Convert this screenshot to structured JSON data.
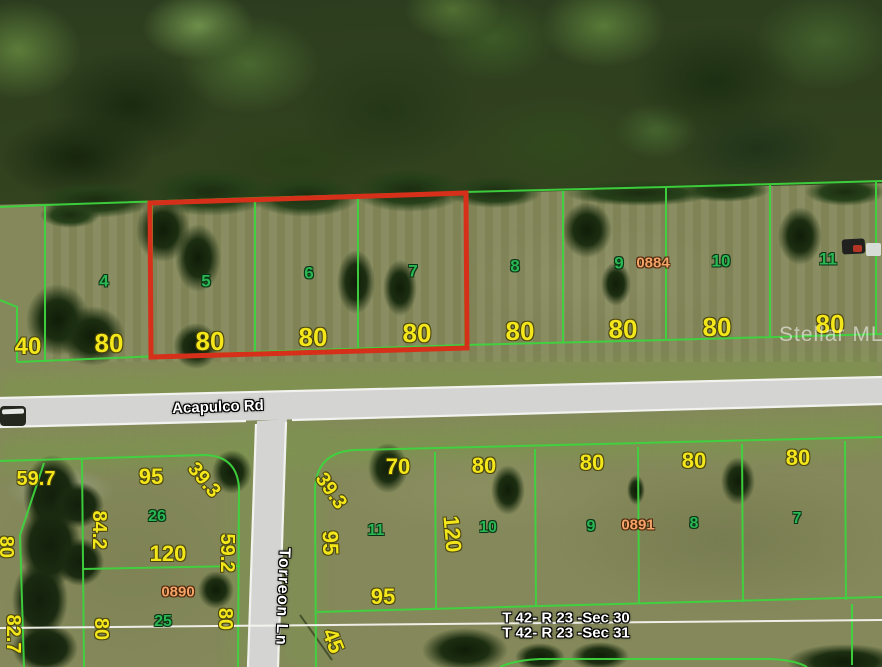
{
  "image": {
    "kind": "aerial plat map photo",
    "width": 882,
    "height": 667
  },
  "watermark": {
    "text": "Stellar MLS"
  },
  "streets": {
    "horizontal": "Acapulco Rd",
    "vertical": "Torreon Ln"
  },
  "section_lines": {
    "above": "T 42- R 23 -Sec 30",
    "below": "T 42- R 23 -Sec 31"
  },
  "highlight": {
    "outlined_lots": [
      "5",
      "6",
      "7"
    ],
    "color": "#d6301a"
  },
  "colors": {
    "plat_line_green": "#3ed43e",
    "lot_number_green": "#2bb654",
    "dimension_yellow": "#f3e71c",
    "plat_book_orange": "#f2a469",
    "highlight_red": "#d6301a",
    "road_gray": "#d4d4d2",
    "section_line_white": "#f5f5f0"
  },
  "map_labels": [
    {
      "text": "40",
      "kind": "dim",
      "x": 28,
      "y": 347,
      "s": 24
    },
    {
      "text": "80",
      "kind": "dim",
      "x": 109,
      "y": 343,
      "s": 26
    },
    {
      "text": "80",
      "kind": "dim",
      "x": 210,
      "y": 341,
      "s": 26
    },
    {
      "text": "80",
      "kind": "dim",
      "x": 313,
      "y": 337,
      "s": 26
    },
    {
      "text": "80",
      "kind": "dim",
      "x": 417,
      "y": 333,
      "s": 26
    },
    {
      "text": "80",
      "kind": "dim",
      "x": 520,
      "y": 331,
      "s": 26
    },
    {
      "text": "80",
      "kind": "dim",
      "x": 623,
      "y": 329,
      "s": 26
    },
    {
      "text": "80",
      "kind": "dim",
      "x": 717,
      "y": 327,
      "s": 26
    },
    {
      "text": "80",
      "kind": "dim",
      "x": 830,
      "y": 324,
      "s": 26
    },
    {
      "text": "4",
      "kind": "lot",
      "x": 104,
      "y": 281,
      "s": 17
    },
    {
      "text": "5",
      "kind": "lot",
      "x": 206,
      "y": 281,
      "s": 17
    },
    {
      "text": "6",
      "kind": "lot",
      "x": 309,
      "y": 273,
      "s": 17
    },
    {
      "text": "7",
      "kind": "lot",
      "x": 413,
      "y": 271,
      "s": 17
    },
    {
      "text": "8",
      "kind": "lot",
      "x": 515,
      "y": 266,
      "s": 17
    },
    {
      "text": "9",
      "kind": "lot",
      "x": 619,
      "y": 263,
      "s": 17
    },
    {
      "text": "0884",
      "kind": "plat",
      "x": 653,
      "y": 263,
      "s": 15
    },
    {
      "text": "10",
      "kind": "lot",
      "x": 721,
      "y": 261,
      "s": 17
    },
    {
      "text": "11",
      "kind": "lot",
      "x": 828,
      "y": 259,
      "s": 17
    },
    {
      "text": "59.7",
      "kind": "dim",
      "x": 36,
      "y": 479,
      "s": 20
    },
    {
      "text": "95",
      "kind": "dim",
      "x": 151,
      "y": 477,
      "s": 22
    },
    {
      "text": "39.3",
      "kind": "dim",
      "x": 204,
      "y": 480,
      "s": 20,
      "r": 50
    },
    {
      "text": "84.2",
      "kind": "dim",
      "x": 99,
      "y": 530,
      "s": 20,
      "r": 90
    },
    {
      "text": "26",
      "kind": "lot",
      "x": 157,
      "y": 517,
      "s": 16
    },
    {
      "text": "120",
      "kind": "dim",
      "x": 168,
      "y": 554,
      "s": 22
    },
    {
      "text": "59.2",
      "kind": "dim",
      "x": 227,
      "y": 553,
      "s": 20,
      "r": 90
    },
    {
      "text": "0890",
      "kind": "plat",
      "x": 178,
      "y": 592,
      "s": 15
    },
    {
      "text": "25",
      "kind": "lot",
      "x": 163,
      "y": 622,
      "s": 16
    },
    {
      "text": "80",
      "kind": "dim",
      "x": 101,
      "y": 629,
      "s": 20,
      "r": 90
    },
    {
      "text": "80",
      "kind": "dim",
      "x": 225,
      "y": 619,
      "s": 20,
      "r": 90
    },
    {
      "text": "80",
      "kind": "dim",
      "x": 6,
      "y": 547,
      "s": 20,
      "r": 90
    },
    {
      "text": "82.7",
      "kind": "dim",
      "x": 13,
      "y": 634,
      "s": 20,
      "r": 90
    },
    {
      "text": "39.3",
      "kind": "dim",
      "x": 331,
      "y": 491,
      "s": 20,
      "r": 55
    },
    {
      "text": "70",
      "kind": "dim",
      "x": 398,
      "y": 467,
      "s": 22
    },
    {
      "text": "95",
      "kind": "dim",
      "x": 330,
      "y": 543,
      "s": 22,
      "r": 88
    },
    {
      "text": "11",
      "kind": "lot",
      "x": 376,
      "y": 531,
      "s": 16
    },
    {
      "text": "120",
      "kind": "dim",
      "x": 452,
      "y": 534,
      "s": 22,
      "r": 85
    },
    {
      "text": "10",
      "kind": "lot",
      "x": 488,
      "y": 528,
      "s": 16
    },
    {
      "text": "80",
      "kind": "dim",
      "x": 484,
      "y": 466,
      "s": 22
    },
    {
      "text": "80",
      "kind": "dim",
      "x": 592,
      "y": 463,
      "s": 22
    },
    {
      "text": "9",
      "kind": "lot",
      "x": 591,
      "y": 527,
      "s": 16
    },
    {
      "text": "0891",
      "kind": "plat",
      "x": 638,
      "y": 525,
      "s": 15
    },
    {
      "text": "80",
      "kind": "dim",
      "x": 694,
      "y": 461,
      "s": 22
    },
    {
      "text": "8",
      "kind": "lot",
      "x": 694,
      "y": 524,
      "s": 16
    },
    {
      "text": "80",
      "kind": "dim",
      "x": 798,
      "y": 458,
      "s": 22
    },
    {
      "text": "7",
      "kind": "lot",
      "x": 797,
      "y": 519,
      "s": 16
    },
    {
      "text": "95",
      "kind": "dim",
      "x": 383,
      "y": 597,
      "s": 22
    },
    {
      "text": "45",
      "kind": "dim",
      "x": 333,
      "y": 641,
      "s": 22,
      "r": 68
    }
  ]
}
